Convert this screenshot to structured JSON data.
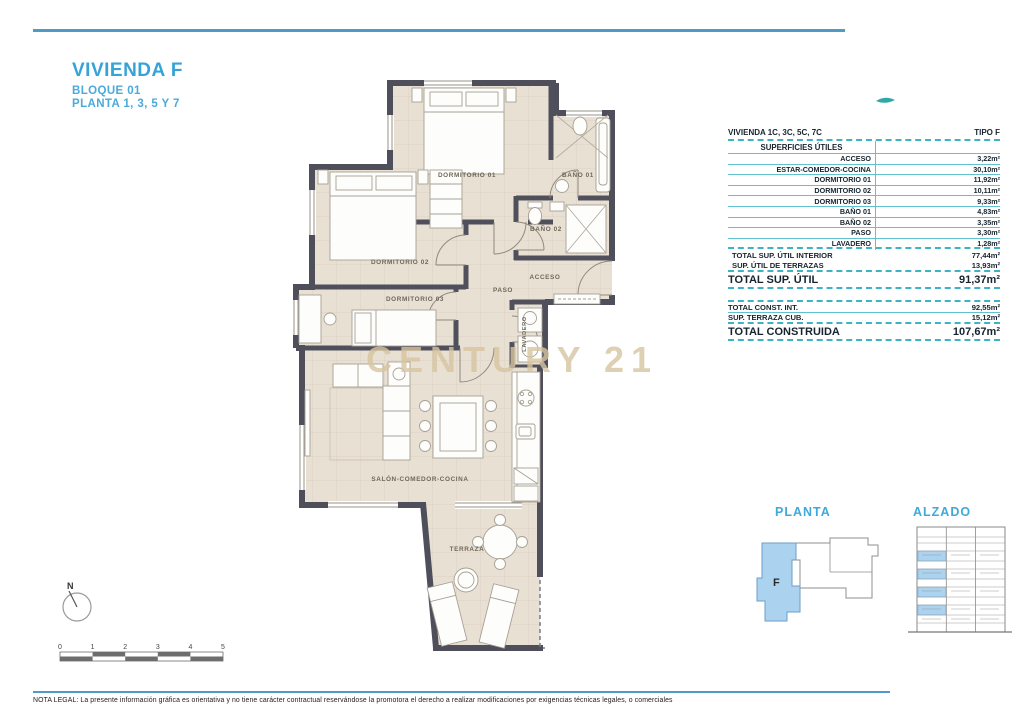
{
  "title": {
    "main": "VIVIENDA F",
    "block": "BLOQUE 01",
    "floors": "PLANTA 1, 3, 5 Y 7"
  },
  "table": {
    "header_left": "VIVIENDA 1C, 3C, 5C, 7C",
    "header_right": "TIPO F",
    "section_title": "SUPERFICIES ÚTILES",
    "rows": [
      {
        "label": "ACCESO",
        "value": "3,22m²"
      },
      {
        "label": "ESTAR-COMEDOR-COCINA",
        "value": "30,10m²"
      },
      {
        "label": "DORMITORIO 01",
        "value": "11,92m²"
      },
      {
        "label": "DORMITORIO 02",
        "value": "10,11m²"
      },
      {
        "label": "DORMITORIO 03",
        "value": "9,33m²"
      },
      {
        "label": "BAÑO 01",
        "value": "4,83m²"
      },
      {
        "label": "BAÑO 02",
        "value": "3,35m²"
      },
      {
        "label": "PASO",
        "value": "3,30m²"
      },
      {
        "label": "LAVADERO",
        "value": "1,28m²"
      }
    ],
    "subtotals": [
      {
        "label": "TOTAL SUP. ÚTIL INTERIOR",
        "value": "77,44m²"
      },
      {
        "label": "SUP. ÚTIL DE TERRAZAS",
        "value": "13,93m²"
      }
    ],
    "total_util": {
      "label": "TOTAL SUP. ÚTIL",
      "value": "91,37m²"
    },
    "const_rows": [
      {
        "label": "TOTAL CONST. INT.",
        "value": "92,55m²"
      },
      {
        "label": "SUP. TERRAZA CUB.",
        "value": "15,12m²"
      }
    ],
    "total_construida": {
      "label": "TOTAL CONSTRUIDA",
      "value": "107,67m²"
    }
  },
  "plan": {
    "labels": {
      "dormitorio_01": "DORMITORIO 01",
      "bano_01": "BAÑO 01",
      "dormitorio_02": "DORMITORIO 02",
      "bano_02": "BAÑO 02",
      "acceso": "ACCESO",
      "paso": "PASO",
      "dormitorio_03": "DORMITORIO 03",
      "lavadero": "LAVADERO",
      "salon": "SALÓN-COMEDOR-COCINA",
      "terraza": "TERRAZA"
    }
  },
  "watermark": "CENTURY 21",
  "key_plans": {
    "planta_label": "PLANTA",
    "alzado_label": "ALZADO",
    "unit_letter": "F"
  },
  "compass": {
    "north": "N"
  },
  "scale_bar": {
    "ticks": [
      "0",
      "1",
      "2",
      "3",
      "4",
      "5"
    ]
  },
  "legal_note": "NOTA LEGAL: La presente información gráfica es orientativa y no tiene carácter contractual reservándose la promotora el derecho a realizar modificaciones por exigencias técnicas legales, o comerciales",
  "colors": {
    "accent_blue": "#35a3d8",
    "table_teal": "#3fb3c6",
    "wall": "#4f4e5b",
    "floor": "#e9e0d4",
    "unit_highlight": "#abd3f0",
    "watermark": "#d7c5a0"
  }
}
